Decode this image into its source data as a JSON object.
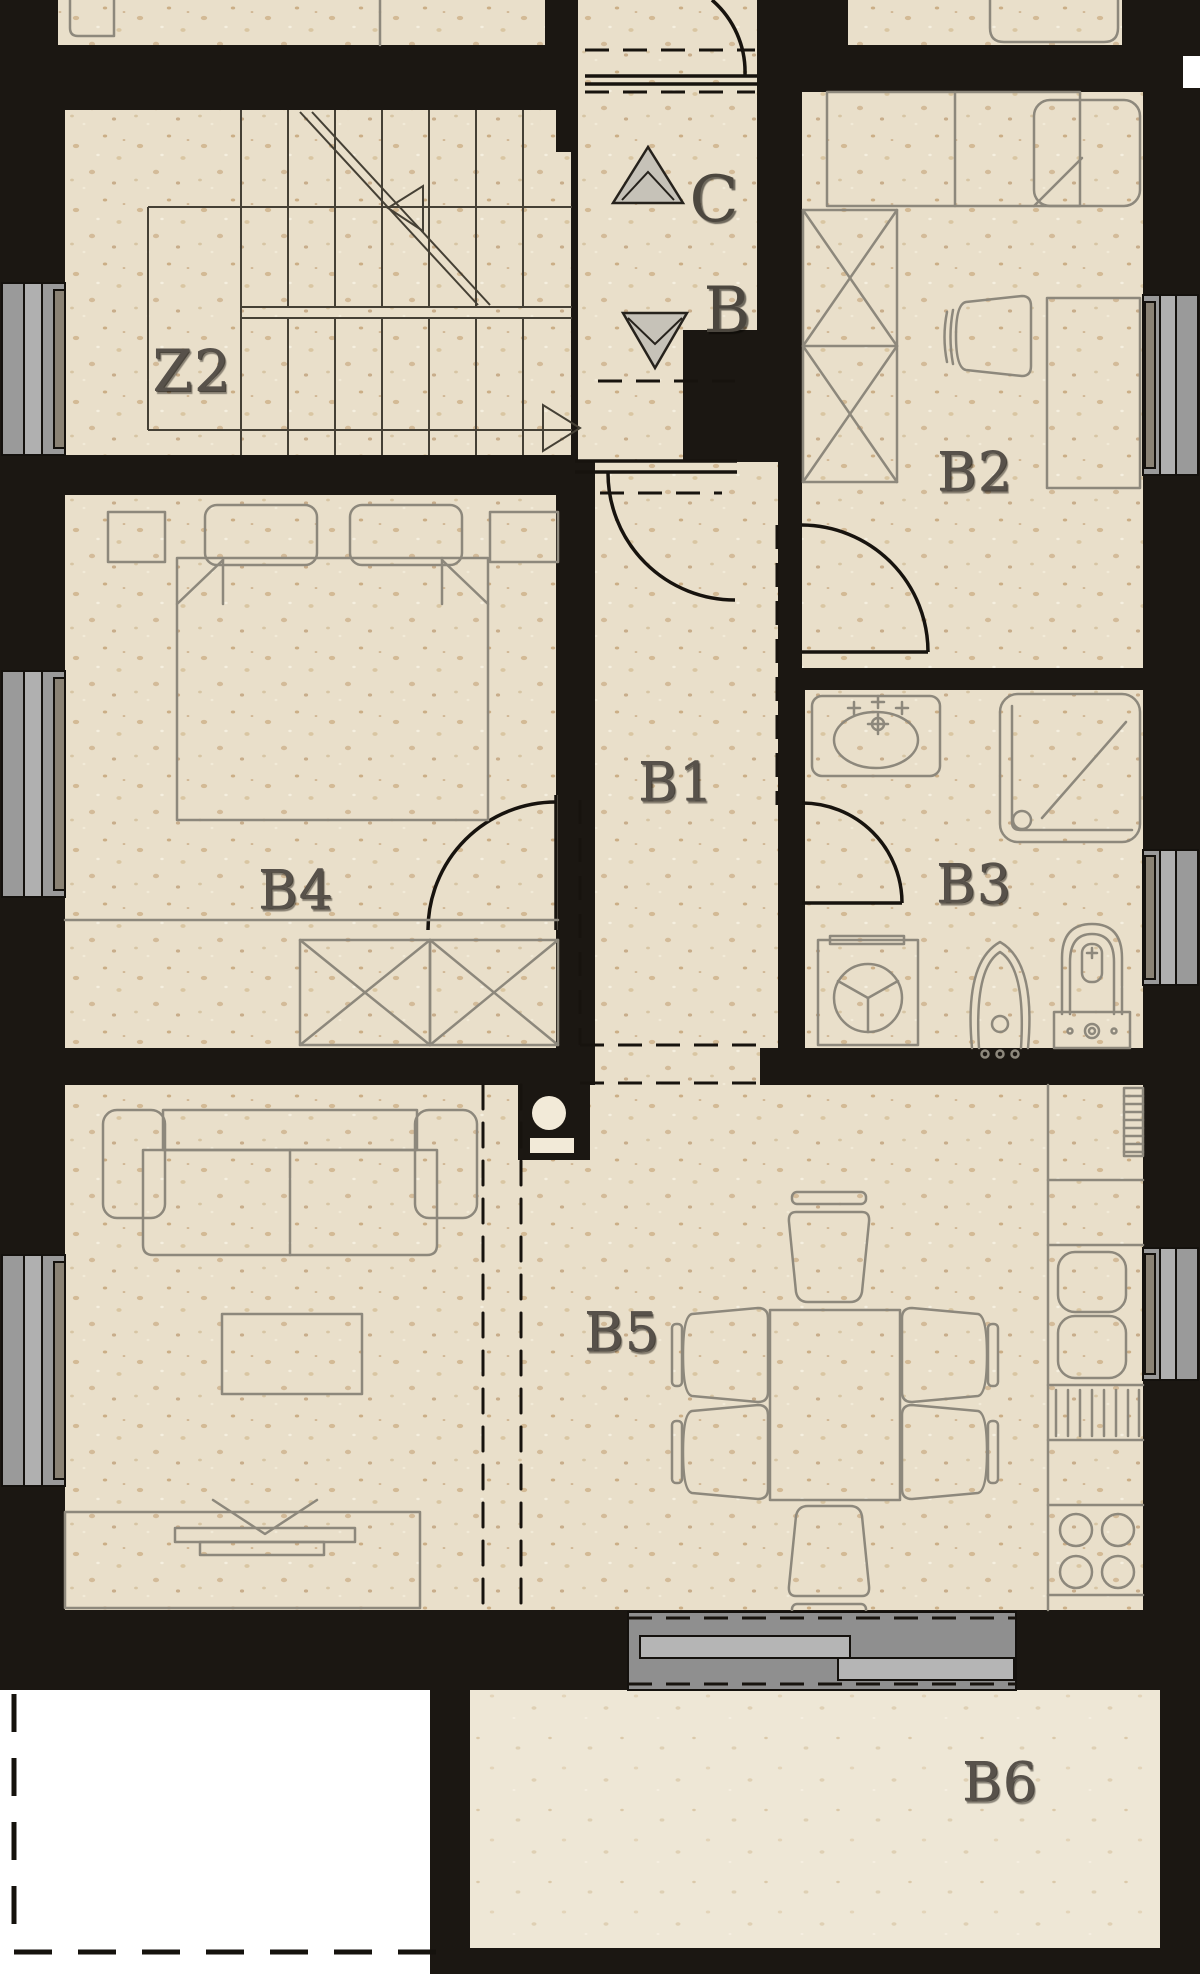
{
  "plan": {
    "type": "architectural floor plan",
    "unit": "B",
    "rooms": [
      {
        "id": "z2",
        "label": "Z2"
      },
      {
        "id": "b1",
        "label": "B1"
      },
      {
        "id": "b2",
        "label": "B2"
      },
      {
        "id": "b3",
        "label": "B3"
      },
      {
        "id": "b4",
        "label": "B4"
      },
      {
        "id": "b5",
        "label": "B5"
      },
      {
        "id": "b6",
        "label": "B6"
      }
    ],
    "markers": [
      {
        "id": "stairs-up",
        "label": "C"
      },
      {
        "id": "stairs-down",
        "label": "B"
      }
    ],
    "colors": {
      "wall": "#1b1712",
      "floor": "#e9dfca",
      "terrace_floor": "#eee7d6",
      "furniture_line": "#8d887c",
      "door_line": "#17130e",
      "window_frame": "#9a9a9a",
      "window_frame_light": "#b0b0b0",
      "sliding_door": "#8f8f8f",
      "label": "#57514a",
      "outside": "#ffffff"
    }
  }
}
